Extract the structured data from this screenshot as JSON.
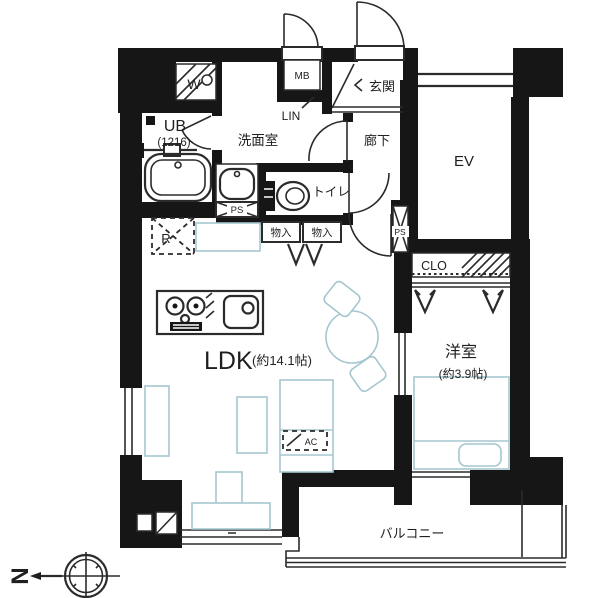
{
  "floorplan": {
    "type": "apartment-floor-plan",
    "labels": {
      "ldk": "LDK",
      "ldk_size": "(約14.1帖)",
      "western_room": "洋室",
      "western_room_size": "(約3.9帖)",
      "washroom": "洗面室",
      "entrance": "玄関",
      "hallway": "廊下",
      "toilet": "トイレ",
      "balcony": "バルコニー",
      "elevator": "EV",
      "unit_bath": "UB",
      "unit_bath_size": "(1216)",
      "meter_box": "MB",
      "linen": "LIN",
      "closet": "CLO",
      "pipe_space": "PS",
      "storage": "物入",
      "washer": "W",
      "refrigerator": "R",
      "air_conditioner": "AC",
      "compass_north": "N"
    },
    "colors": {
      "wall": "#161616",
      "line": "#2b2b2b",
      "furniture": "#a5c6cf",
      "background": "#ffffff"
    }
  }
}
